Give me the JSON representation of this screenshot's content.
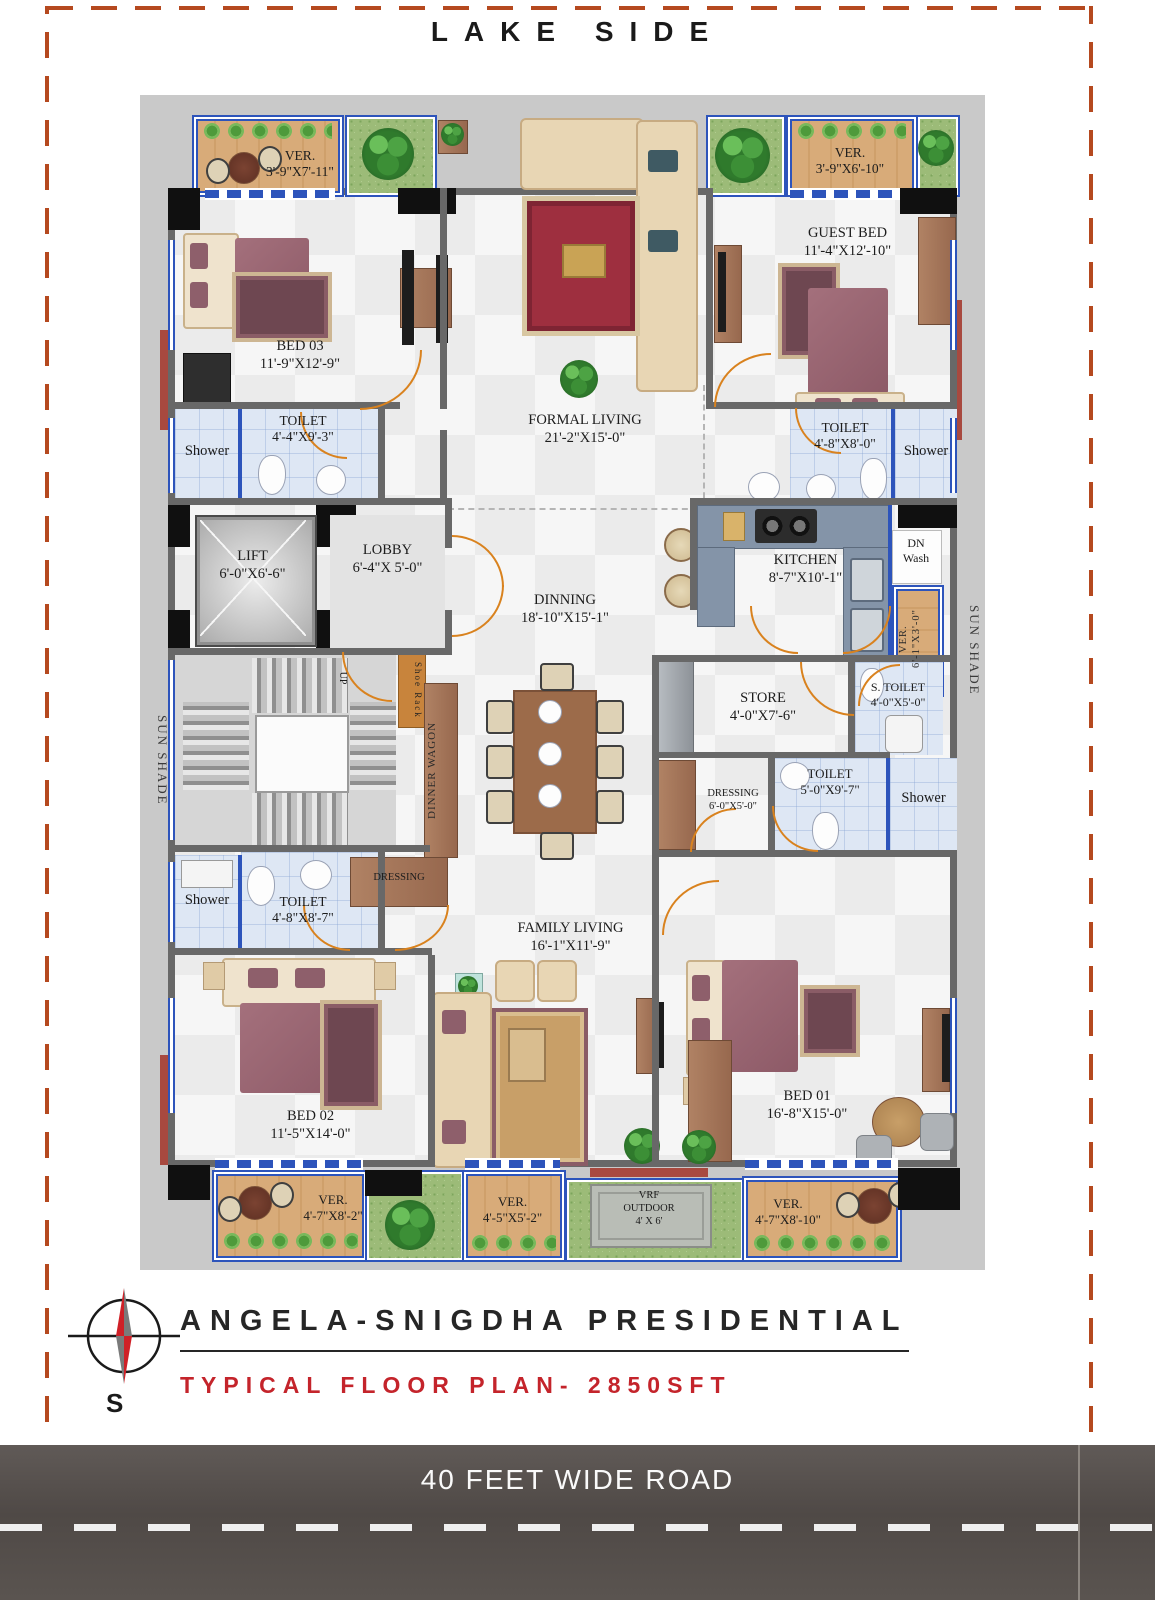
{
  "site": {
    "lake_side": "LAKE SIDE",
    "road": "40 FEET WIDE ROAD",
    "compass_south": "S"
  },
  "title_block": {
    "project": "ANGELA-SNIGDHA PRESIDENTIAL",
    "subtitle": "TYPICAL FLOOR PLAN- 2850SFT"
  },
  "rooms": {
    "ver_tl": {
      "lines": [
        "VER.",
        "3'-9\"X7'-11\""
      ]
    },
    "bed03": {
      "lines": [
        "BED 03",
        "11'-9\"X12'-9\""
      ]
    },
    "formal_living": {
      "lines": [
        "FORMAL LIVING",
        "21'-2\"X15'-0\""
      ]
    },
    "ver_tr": {
      "lines": [
        "VER.",
        "3'-9\"X6'-10\""
      ]
    },
    "guest_bed": {
      "lines": [
        "GUEST BED",
        "11'-4\"X12'-10\""
      ]
    },
    "shower_bed03": {
      "lines": [
        "Shower"
      ]
    },
    "toilet_bed03": {
      "lines": [
        "TOILET",
        "4'-4\"X9'-3\""
      ]
    },
    "toilet_guest": {
      "lines": [
        "TOILET",
        "4'-8\"X8'-0\""
      ]
    },
    "shower_guest": {
      "lines": [
        "Shower"
      ]
    },
    "lift": {
      "lines": [
        "LIFT",
        "6'-0\"X6'-6\""
      ]
    },
    "lobby": {
      "lines": [
        "LOBBY",
        "6'-4\"X 5'-0\""
      ]
    },
    "kitchen": {
      "lines": [
        "KITCHEN",
        "8'-7\"X10'-1\""
      ]
    },
    "dn_wash": {
      "lines": [
        "DN",
        "Wash"
      ]
    },
    "ver_kitchen": {
      "lines": [
        "VER.",
        "6'-1\"X3'-0\""
      ]
    },
    "sun_shade_right": {
      "lines": [
        "SUN SHADE"
      ]
    },
    "sun_shade_left": {
      "lines": [
        "SUN SHADE"
      ]
    },
    "dinning": {
      "lines": [
        "DINNING",
        "18'-10\"X15'-1\""
      ]
    },
    "store": {
      "lines": [
        "STORE",
        "4'-0\"X7'-6\""
      ]
    },
    "s_toilet": {
      "lines": [
        "S. TOILET",
        "4'-0\"X5'-0\""
      ]
    },
    "dressing_bed01": {
      "lines": [
        "DRESSING",
        "6'-0\"X5'-0\""
      ]
    },
    "toilet_bed01": {
      "lines": [
        "TOILET",
        "5'-0\"X9'-7\""
      ]
    },
    "shower_bed01": {
      "lines": [
        "Shower"
      ]
    },
    "shoe_rack": {
      "lines": [
        "Shoe Rack"
      ]
    },
    "dinner_wagon": {
      "lines": [
        "DINNER WAGON"
      ]
    },
    "stairs_up": {
      "lines": [
        "UP"
      ]
    },
    "dressing_bed02": {
      "lines": [
        "DRESSING"
      ]
    },
    "toilet_bed02": {
      "lines": [
        "TOILET",
        "4'-8\"X8'-7\""
      ]
    },
    "shower_bed02": {
      "lines": [
        "Shower"
      ]
    },
    "family_living": {
      "lines": [
        "FAMILY LIVING",
        "16'-1\"X11'-9\""
      ]
    },
    "bed02": {
      "lines": [
        "BED 02",
        "11'-5\"X14'-0\""
      ]
    },
    "bed01": {
      "lines": [
        "BED 01",
        "16'-8\"X15'-0\""
      ]
    },
    "ver_bl": {
      "lines": [
        "VER.",
        "4'-7\"X8'-2\""
      ]
    },
    "ver_bm": {
      "lines": [
        "VER.",
        "4'-5\"X5'-2\""
      ]
    },
    "vrf_outdoor": {
      "lines": [
        "VRF",
        "OUTDOOR",
        "4' X 6'"
      ]
    },
    "ver_br": {
      "lines": [
        "VER.",
        "4'-7\"X8'-10\""
      ]
    }
  },
  "colors": {
    "property_line": "#b5491f",
    "road_bg": "#575150",
    "title_accent": "#c4242b",
    "wall": "#686868",
    "window_blue": "#2d54bb",
    "door_orange": "#d9821e",
    "veranda_wood": "#d8ab79",
    "grass": "#9cbb78",
    "toilet_tile": "#dee7f4",
    "bed_maroon": "#9b6b77",
    "kitchen_counter": "#8494a8"
  }
}
